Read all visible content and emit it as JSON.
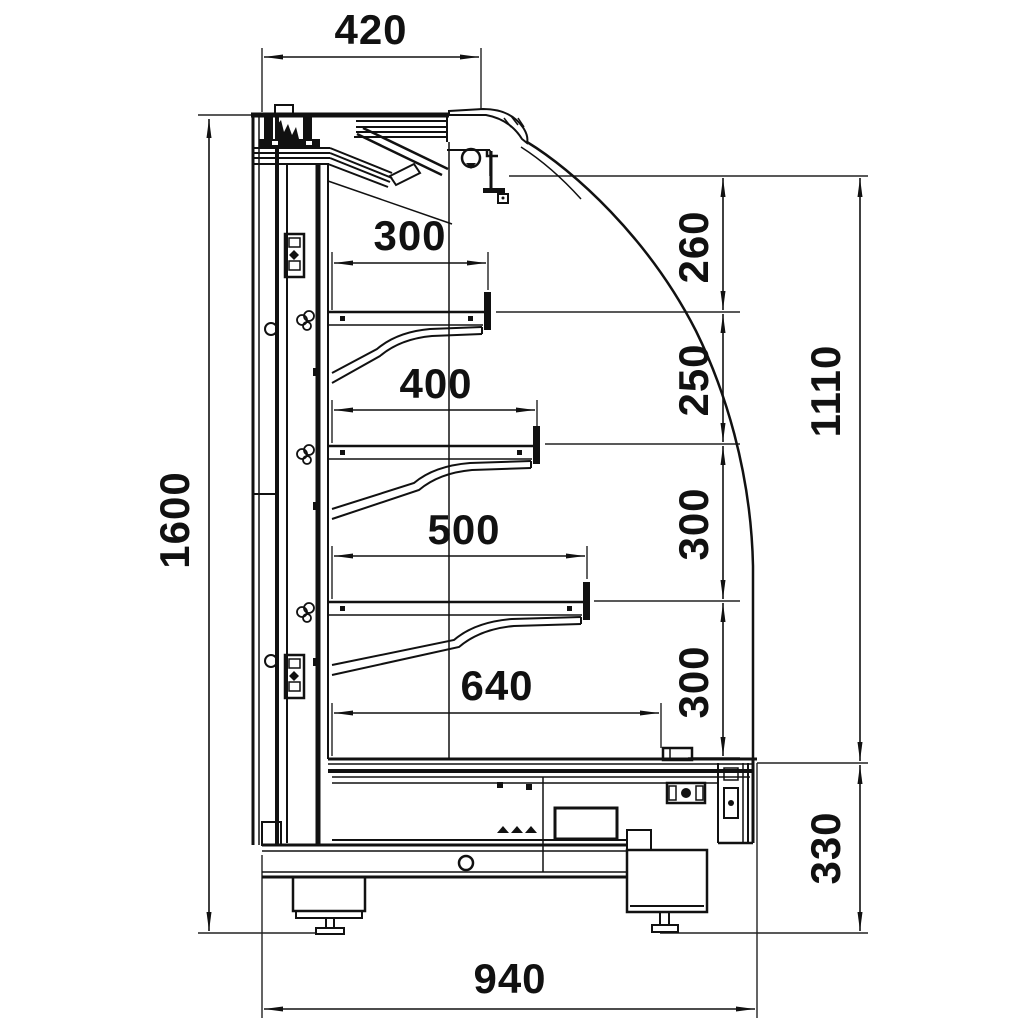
{
  "drawing": {
    "dims": {
      "top_width": "420",
      "overall_height": "1600",
      "shelf1_depth": "300",
      "shelf2_depth": "400",
      "shelf3_depth": "500",
      "bottom_shelf_depth": "640",
      "gap_top": "260",
      "gap_shelf1_shelf2": "250",
      "gap_shelf2_shelf3": "300",
      "gap_shelf3_deck": "300",
      "front_opening_height": "1110",
      "base_height": "330",
      "overall_depth": "940"
    }
  }
}
